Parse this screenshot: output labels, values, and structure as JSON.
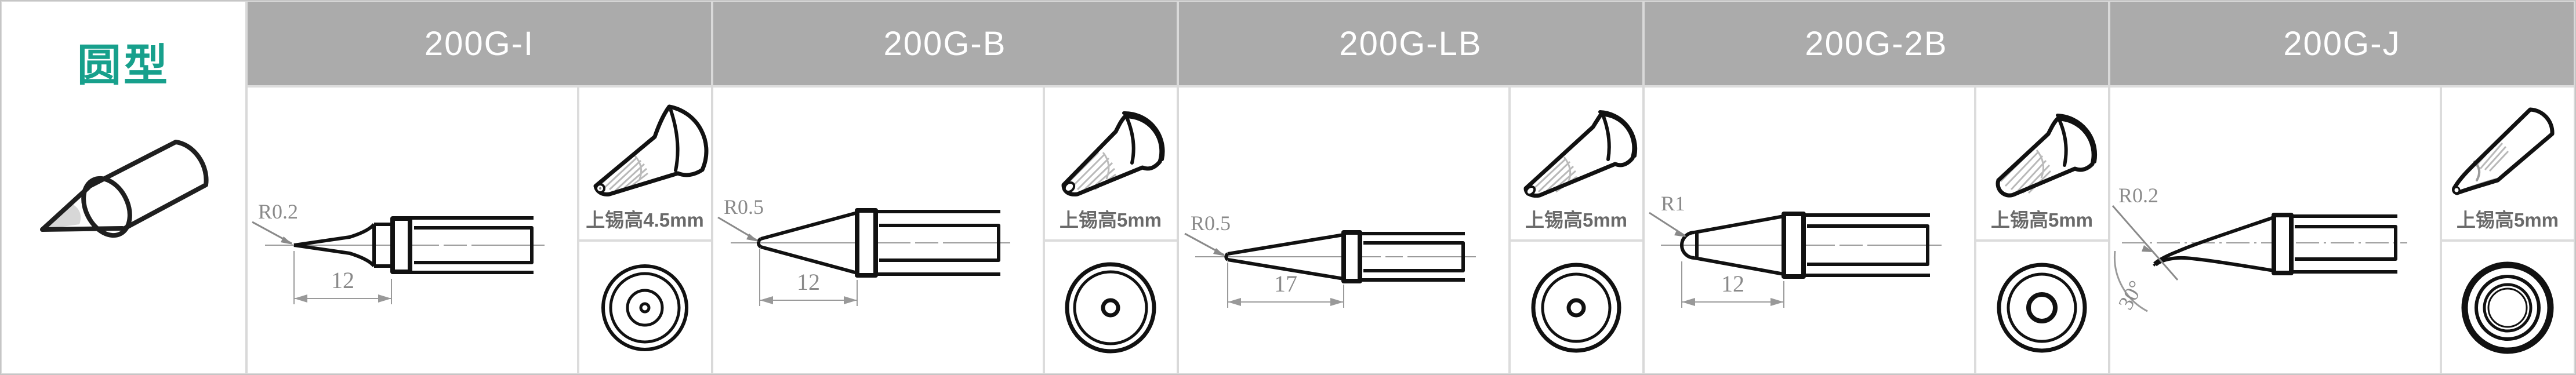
{
  "page": {
    "category_label": "圆型",
    "category_meaning": "round type soldering tips"
  },
  "colors": {
    "accent_teal": "#17a08c",
    "header_gray": "#ababab",
    "dimension_gray": "#8a8a8a",
    "label_gray": "#6a6a6a",
    "outline_black": "#111111"
  },
  "columns": [
    {
      "model": "200G-I",
      "radius_label": "R0.2",
      "length_label": "12",
      "tin_height_label": "上锡高4.5mm"
    },
    {
      "model": "200G-B",
      "radius_label": "R0.5",
      "length_label": "12",
      "tin_height_label": "上锡高5mm"
    },
    {
      "model": "200G-LB",
      "radius_label": "R0.5",
      "length_label": "17",
      "tin_height_label": "上锡高5mm"
    },
    {
      "model": "200G-2B",
      "radius_label": "R1",
      "length_label": "12",
      "tin_height_label": "上锡高5mm"
    },
    {
      "model": "200G-J",
      "radius_label": "R0.2",
      "angle_label": "30°",
      "tin_height_label": "上锡高5mm"
    }
  ]
}
